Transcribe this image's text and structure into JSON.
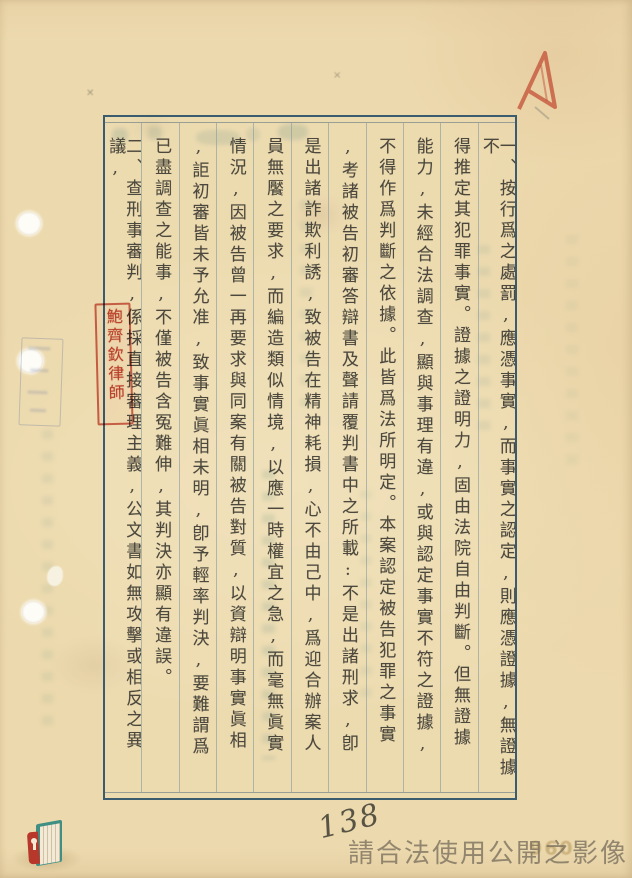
{
  "page": {
    "page_number_handwritten": "138",
    "watermark_text": "請合法使用公開之影像",
    "faint_stamp_number": "096",
    "lawyer_seal_text": "鮑齊欽律師",
    "columns": [
      "一、按行爲之處罰,應憑事實,而事實之認定,則應憑證據,無證據不",
      "得推定其犯罪事實。證據之證明力,固由法院自由判斷。但無證據",
      "能力,未經合法調查,顯與事理有違,或與認定事實不符之證據,",
      "不得作爲判斷之依據。此皆爲法所明定。本案認定被告犯罪之事實",
      ",考諸被告初審答辯書及聲請覆判書中之所載:不是出諸刑求,卽",
      "是出諸詐欺利誘,致被告在精神耗損,心不由己中,爲迎合辦案人",
      "員無饜之要求,而編造類似情境,以應一時權宜之急,而毫無眞實",
      "情況,因被告曾一再要求與同案有關被告對質,以資辯明事實眞相",
      ",詎初審皆未予允准,致事實眞相未明,卽予輕率判決,要難謂爲",
      "已盡調查之能事,不僅被告含冤難伸,其判決亦顯有違誤。",
      "二、查刑事審判,係採直接審理主義,公文書如無攻擊或相反之異議,"
    ]
  },
  "colors": {
    "paper": "#ecd9ad",
    "frame_border": "#3b5b6e",
    "column_line": "#8c9ea0",
    "text_ink": "#3e3c34",
    "stamp_red": "#c13a2a",
    "registry_stamp_blue": "#50649b",
    "watermark_gray": "#786e5c",
    "logo_teal": "#3f8f85",
    "logo_red": "#b8372b"
  }
}
